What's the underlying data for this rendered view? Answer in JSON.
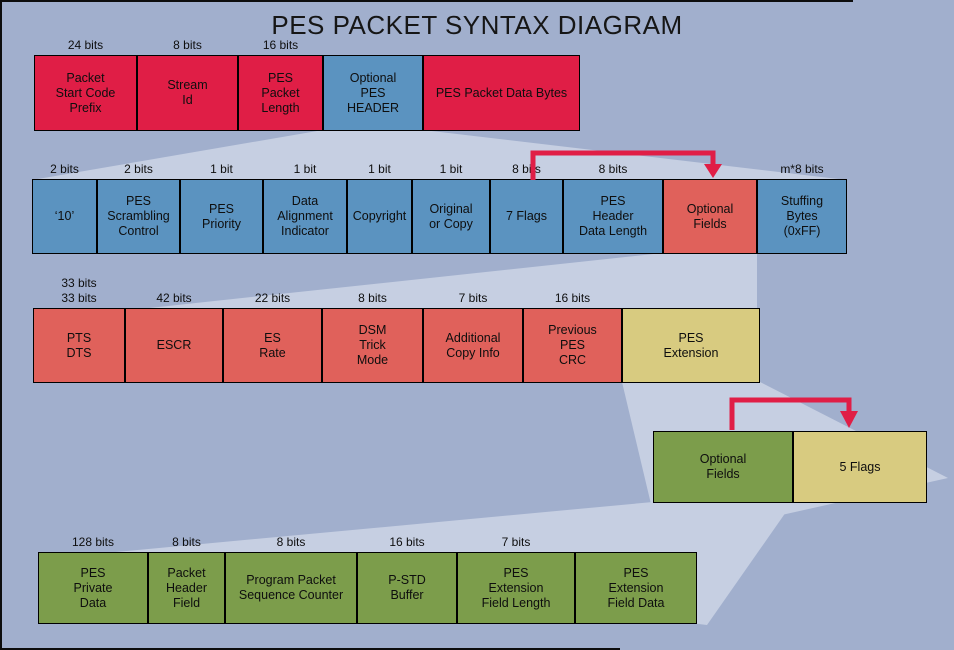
{
  "title": "PES PACKET SYNTAX DIAGRAM",
  "colors": {
    "background": "#a1afcd",
    "fan": "#c6cfe2",
    "red": "#e01e46",
    "blue": "#5b93c0",
    "salmon": "#e0615b",
    "khaki": "#d8cb80",
    "green": "#7c9d4b",
    "arrow": "#e01e46",
    "box_border": "#000000",
    "frame": "#0d0d0d",
    "text": "#0e0e0e"
  },
  "rows": [
    {
      "name": "pes-packet-row",
      "y": 55,
      "height": 76,
      "boxes": [
        {
          "label": "Packet\nStart Code\nPrefix",
          "bits": "24 bits",
          "x": 34,
          "width": 103,
          "color": "red"
        },
        {
          "label": "Stream\nId",
          "bits": "8 bits",
          "x": 137,
          "width": 101,
          "color": "red"
        },
        {
          "label": "PES\nPacket\nLength",
          "bits": "16 bits",
          "x": 238,
          "width": 85,
          "color": "red"
        },
        {
          "label": "Optional\nPES\nHEADER",
          "bits": null,
          "x": 323,
          "width": 100,
          "color": "blue"
        },
        {
          "label": "PES Packet Data Bytes",
          "bits": null,
          "x": 423,
          "width": 157,
          "color": "red"
        }
      ]
    },
    {
      "name": "pes-header-row",
      "y": 179,
      "height": 75,
      "boxes": [
        {
          "label": "‘10’",
          "bits": "2 bits",
          "x": 32,
          "width": 65,
          "color": "blue"
        },
        {
          "label": "PES\nScrambling\nControl",
          "bits": "2 bits",
          "x": 97,
          "width": 83,
          "color": "blue"
        },
        {
          "label": "PES\nPriority",
          "bits": "1 bit",
          "x": 180,
          "width": 83,
          "color": "blue"
        },
        {
          "label": "Data\nAlignment\nIndicator",
          "bits": "1 bit",
          "x": 263,
          "width": 84,
          "color": "blue"
        },
        {
          "label": "Copyright",
          "bits": "1 bit",
          "x": 347,
          "width": 65,
          "color": "blue"
        },
        {
          "label": "Original\nor Copy",
          "bits": "1 bit",
          "x": 412,
          "width": 78,
          "color": "blue"
        },
        {
          "label": "7 Flags",
          "bits": "8 bits",
          "x": 490,
          "width": 73,
          "color": "blue"
        },
        {
          "label": "PES\nHeader\nData Length",
          "bits": "8 bits",
          "x": 563,
          "width": 100,
          "color": "blue"
        },
        {
          "label": "Optional\nFields",
          "bits": null,
          "x": 663,
          "width": 94,
          "color": "salmon"
        },
        {
          "label": "Stuffing\nBytes\n(0xFF)",
          "bits": "m*8 bits",
          "x": 757,
          "width": 90,
          "color": "blue"
        }
      ]
    },
    {
      "name": "optional-fields-row",
      "y": 308,
      "height": 75,
      "boxes": [
        {
          "label": "PTS\nDTS",
          "bits": "33 bits\n33 bits",
          "x": 33,
          "width": 92,
          "color": "salmon"
        },
        {
          "label": "ESCR",
          "bits": "42 bits",
          "x": 125,
          "width": 98,
          "color": "salmon"
        },
        {
          "label": "ES\nRate",
          "bits": "22 bits",
          "x": 223,
          "width": 99,
          "color": "salmon"
        },
        {
          "label": "DSM\nTrick\nMode",
          "bits": "8 bits",
          "x": 322,
          "width": 101,
          "color": "salmon"
        },
        {
          "label": "Additional\nCopy Info",
          "bits": "7 bits",
          "x": 423,
          "width": 100,
          "color": "salmon"
        },
        {
          "label": "Previous\nPES\nCRC",
          "bits": "16 bits",
          "x": 523,
          "width": 99,
          "color": "salmon"
        },
        {
          "label": "PES\nExtension",
          "bits": null,
          "x": 622,
          "width": 138,
          "color": "khaki"
        }
      ]
    },
    {
      "name": "pes-extension-row",
      "y": 431,
      "height": 72,
      "boxes": [
        {
          "label": "Optional\nFields",
          "bits": null,
          "x": 653,
          "width": 140,
          "color": "green"
        },
        {
          "label": "5 Flags",
          "bits": null,
          "x": 793,
          "width": 134,
          "color": "khaki"
        }
      ]
    },
    {
      "name": "extension-fields-row",
      "y": 552,
      "height": 72,
      "boxes": [
        {
          "label": "PES\nPrivate\nData",
          "bits": "128 bits",
          "x": 38,
          "width": 110,
          "color": "green"
        },
        {
          "label": "Packet\nHeader\nField",
          "bits": "8 bits",
          "x": 148,
          "width": 77,
          "color": "green"
        },
        {
          "label": "Program Packet\nSequence Counter",
          "bits": "8 bits",
          "x": 225,
          "width": 132,
          "color": "green"
        },
        {
          "label": "P-STD\nBuffer",
          "bits": "16 bits",
          "x": 357,
          "width": 100,
          "color": "green"
        },
        {
          "label": "PES\nExtension\nField Length",
          "bits": "7 bits",
          "x": 457,
          "width": 118,
          "color": "green"
        },
        {
          "label": "PES\nExtension\nField Data",
          "bits": null,
          "x": 575,
          "width": 122,
          "color": "green"
        }
      ]
    }
  ],
  "arrows": [
    {
      "name": "7-flags-to-optional-fields",
      "from": "7 Flags",
      "to": "Optional Fields"
    },
    {
      "name": "optional-fields-to-5-flags",
      "from": "Optional Fields",
      "to": "5 Flags"
    }
  ],
  "connectors": [
    {
      "from": "Optional PES HEADER",
      "to": "pes-header-row"
    },
    {
      "from": "Optional Fields (PES header)",
      "to": "optional-fields-row"
    },
    {
      "from": "PES Extension",
      "to": "pes-extension-row"
    },
    {
      "from": "Optional Fields (PES extension)",
      "to": "extension-fields-row"
    }
  ]
}
